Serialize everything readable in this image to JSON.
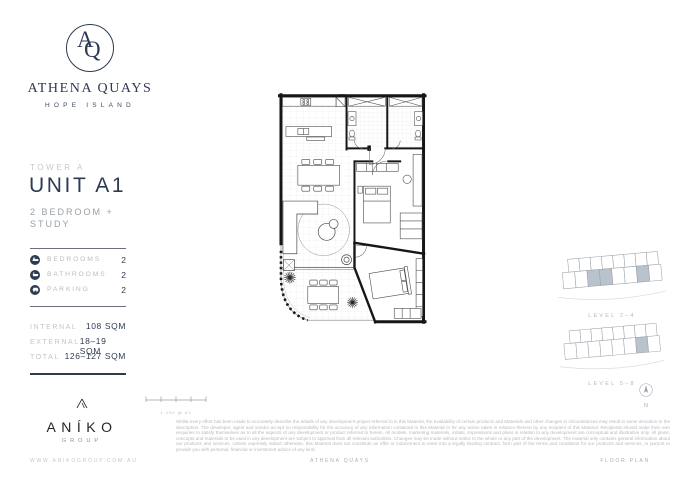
{
  "colors": {
    "navy": "#2e3b52",
    "gray": "#a9aeb5",
    "light_gray": "#c3c6cb",
    "keyplan_highlight": "#b9c3ce"
  },
  "brand": {
    "monogram_a": "A",
    "monogram_q": "Q",
    "name": "ATHENA QUAYS",
    "location": "HOPE ISLAND"
  },
  "unit": {
    "tower": "TOWER A",
    "name": "UNIT A1",
    "type": "2 BEDROOM + STUDY"
  },
  "features": [
    {
      "icon": "bed-icon",
      "label": "BEDROOMS",
      "value": "2"
    },
    {
      "icon": "bath-icon",
      "label": "BATHROOMS",
      "value": "2"
    },
    {
      "icon": "car-icon",
      "label": "PARKING",
      "value": "2"
    }
  ],
  "areas": [
    {
      "label": "INTERNAL",
      "value": "108 SQM"
    },
    {
      "label": "EXTERNAL",
      "value": "18–19 SQM"
    },
    {
      "label": "TOTAL",
      "value": "126–127 SQM"
    }
  ],
  "developer": {
    "name": "ANÍKO",
    "group": "GROUP"
  },
  "keyplans": [
    {
      "label": "LEVEL 2–4"
    },
    {
      "label": "LEVEL 5–8"
    }
  ],
  "compass": {
    "label": "N"
  },
  "scale": {
    "label": "1:100 @ A3"
  },
  "disclaimer": "Whilst every effort has been made to accurately describe the details of any development project referred to in this Material, the availability of certain products and Materials and other changes in circumstances may result in some deviation to the description. The developer, agent and vendor accept no responsibility for the accuracy of any information contained in this Material or for any action taken in reliance thereon by any recipient of this Material. Recipients should make their own enquiries to satisfy themselves as to all the aspects of any development or product referred to herein. All models, marketing materials, initials, impressions and plans in relation to any development are conceptual and illustrative only. All plans, concepts and materials to be used in any development are subject to approval from all relevant authorities. Changes may be made without notice to the whole or any part of the development. The material only contains general information about our products and services. Unless expressly stated otherwise, this Material does not constitute an offer or inducement to enter into a legally binding contract, form part of the terms and conditions for our products and services, or purport to provide you with personal, financial or investment advice of any kind.",
  "footer": {
    "website": "WWW.ANIKOGROUP.COM.AU",
    "center": "ATHENA QUAYS",
    "right": "FLOOR PLAN"
  }
}
